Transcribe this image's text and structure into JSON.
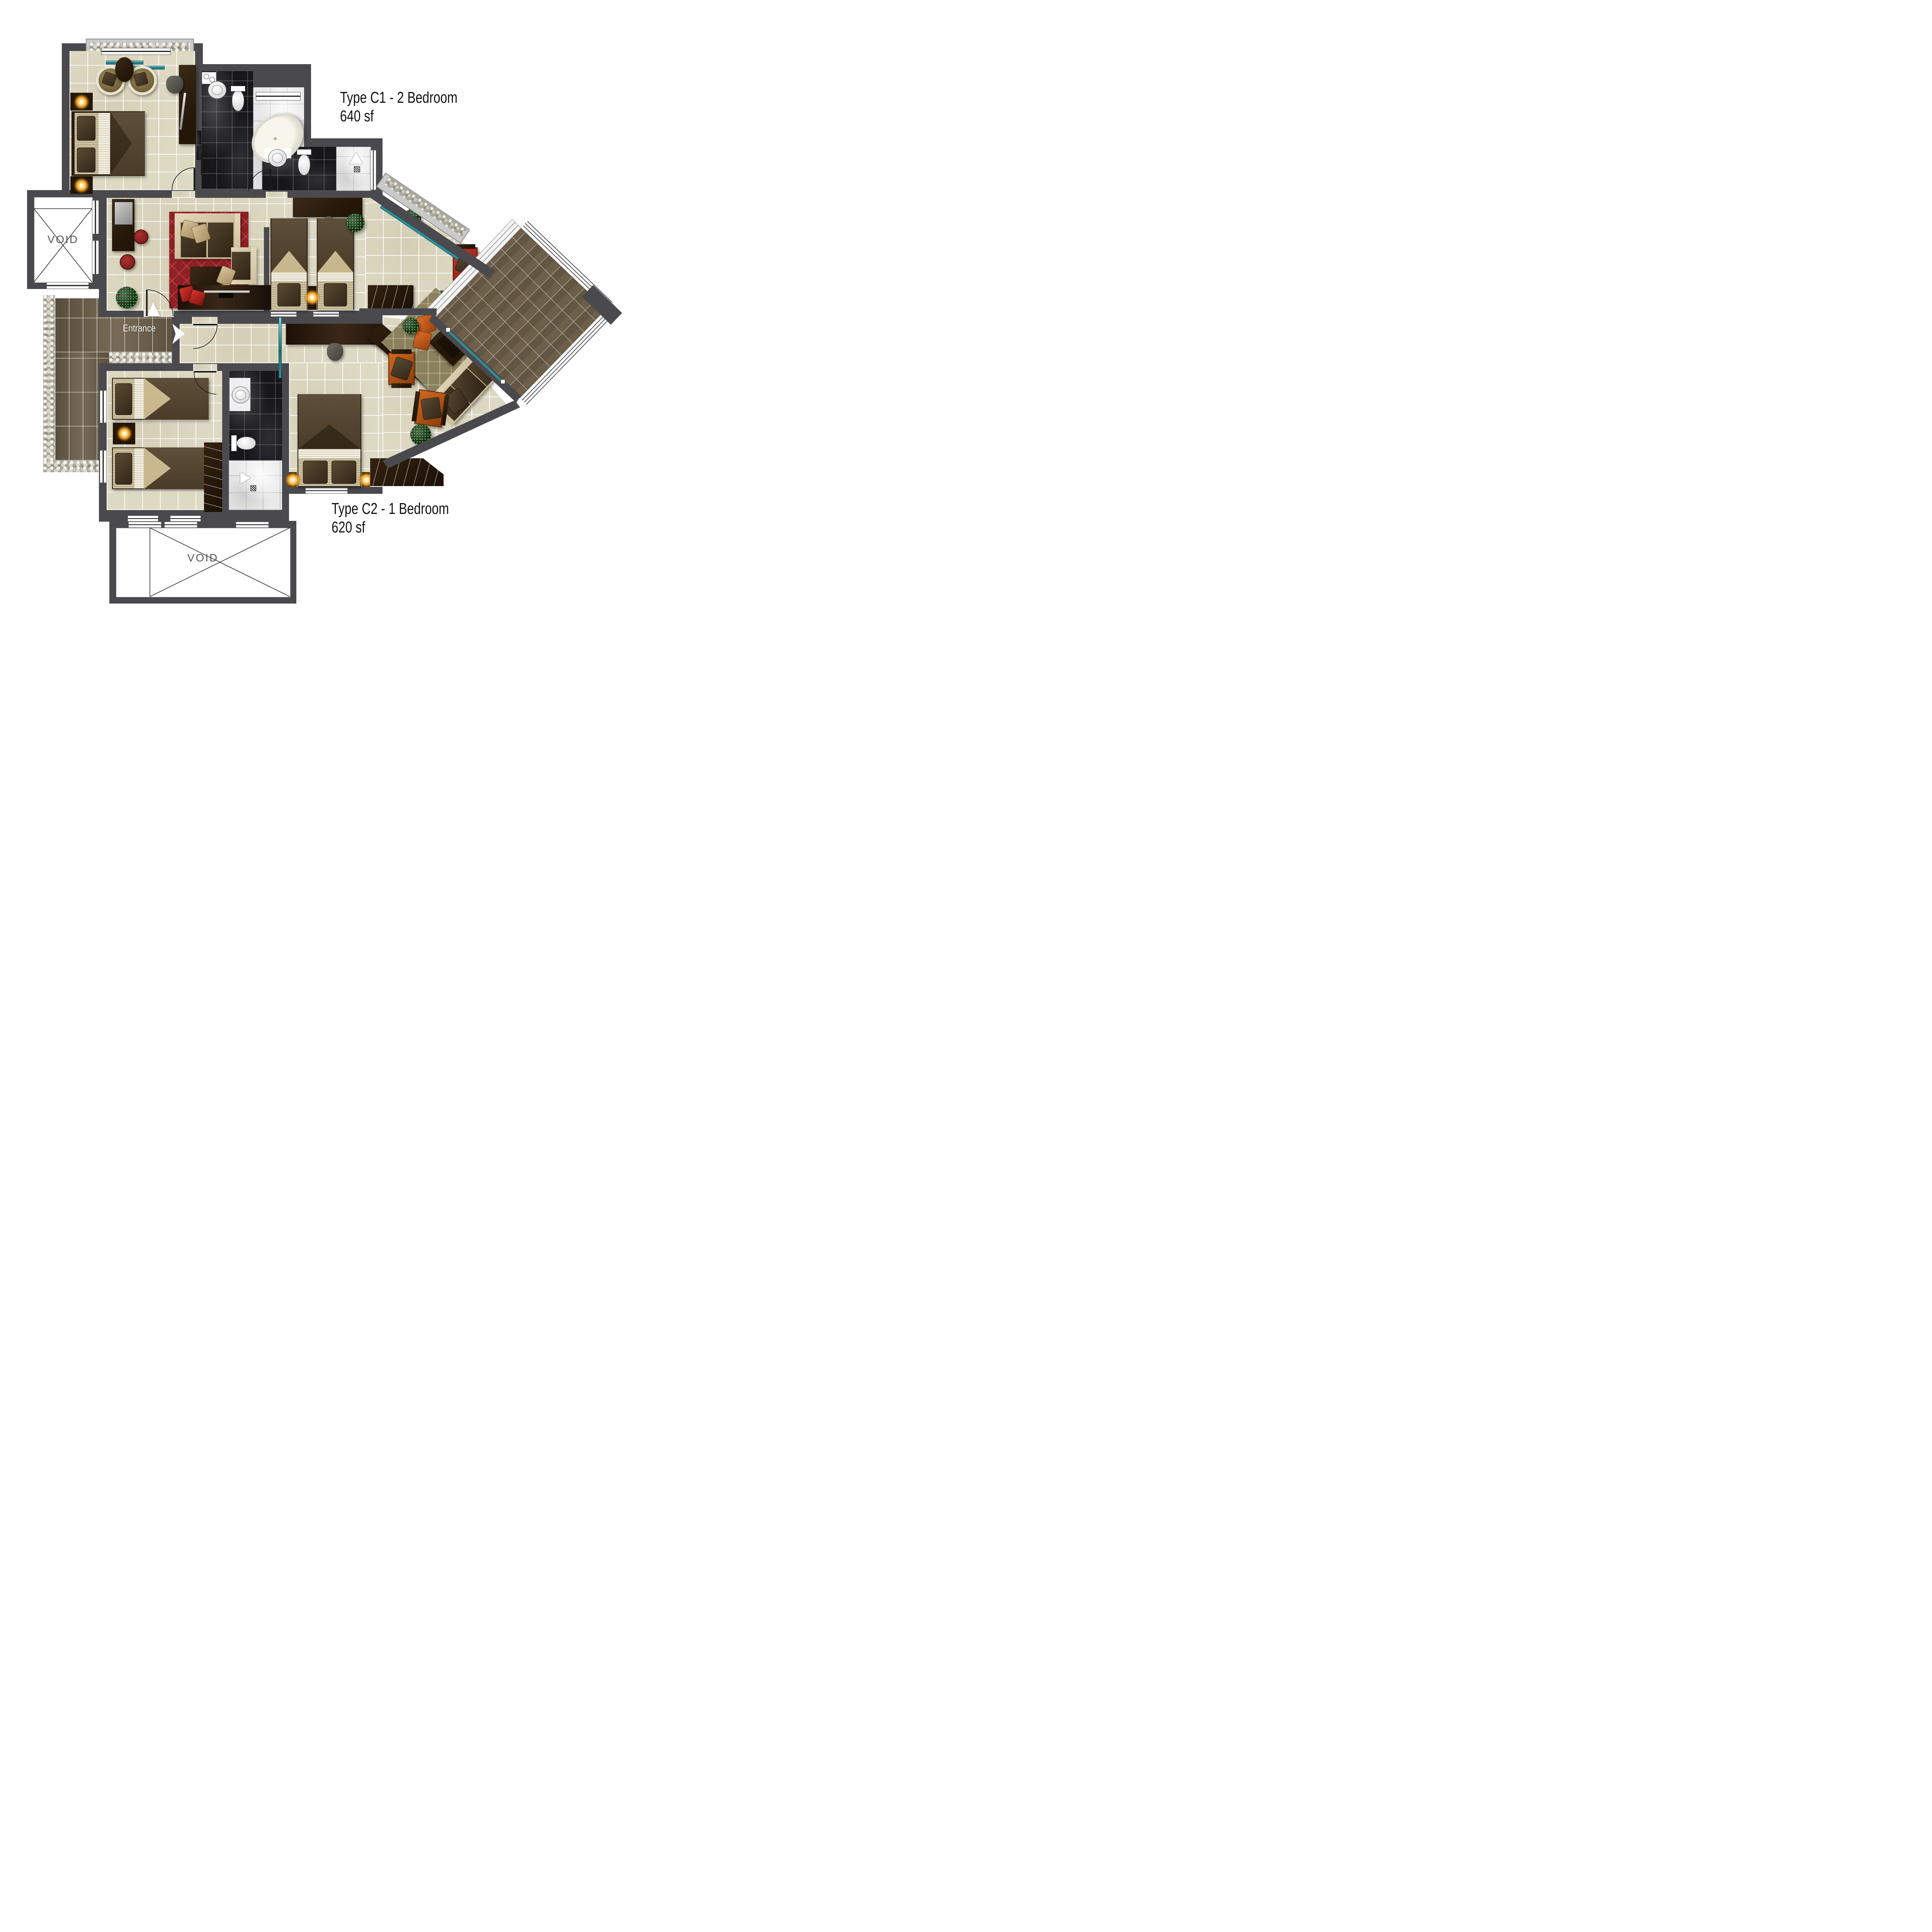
{
  "page": {
    "background": "#ffffff",
    "description": "Residential unit floor plan sheet"
  },
  "labels": {
    "c1_title": "Type C1 - 2 Bedroom",
    "c1_area": "640 sf",
    "c2_title": "Type C2 - 1 Bedroom",
    "c2_area": "620 sf",
    "entrance": "Entrance",
    "void": "VOID"
  },
  "colors": {
    "wall": "#4a4a4e",
    "floor_tile": "#ded9c3",
    "slate_dark": "#17171a",
    "slate_light": "#e9e9e9",
    "terrace_tile": "#6d5f49",
    "path_tile": "#6c5e48",
    "pebble": "#a9a69a",
    "glass_teal": "#2f8d96",
    "rug_red": "#8f2025",
    "rug_olive": "#8a805c",
    "sofa_cream": "#e3d9bd",
    "cushion_brown": "#4a3b28",
    "accent_orange": "#c06010",
    "accent_red": "#b03428",
    "lamp_glow": "#f5a623",
    "plant_green": "#2e7d32",
    "void_text": "#555555",
    "label_text": "#111111"
  }
}
